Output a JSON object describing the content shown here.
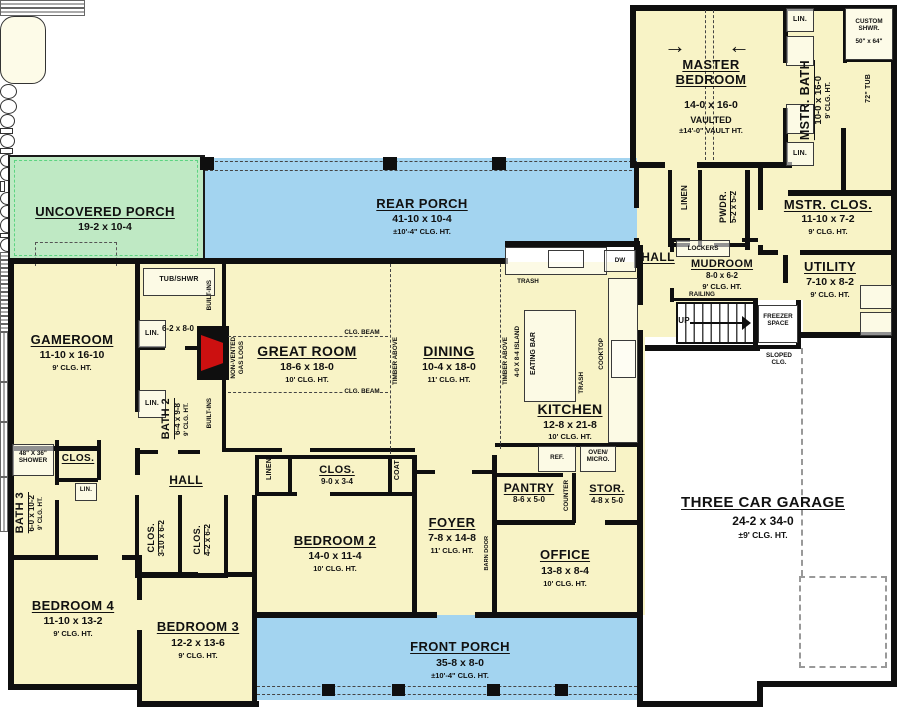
{
  "colors": {
    "room_fill": "#f8f3c6",
    "porch_blue": "#a3d4f0",
    "porch_green": "#bfe9c4",
    "wall": "#0f0f0f",
    "fireplace_red": "#cc1010",
    "garage_fill": "#ffffff"
  },
  "rooms": {
    "master_bedroom": {
      "name": "MASTER BEDROOM",
      "dim": "14-0 x 16-0",
      "note": "VAULTED",
      "clg": "±14'-0\" VAULT HT."
    },
    "mstr_bath": {
      "name": "MSTR. BATH",
      "dim": "10-0 x 16-0",
      "clg": "9' CLG. HT."
    },
    "mstr_clos": {
      "name": "MSTR. CLOS.",
      "dim": "11-10 x 7-2",
      "clg": "9' CLG. HT."
    },
    "utility": {
      "name": "UTILITY",
      "dim": "7-10 x 8-2",
      "clg": "9' CLG. HT."
    },
    "mudroom": {
      "name": "MUDROOM",
      "dim": "8-0 x 6-2",
      "clg": "9' CLG. HT."
    },
    "pwdr": {
      "name": "PWDR.",
      "dim": "5-2 x 5-2"
    },
    "rear_porch": {
      "name": "REAR PORCH",
      "dim": "41-10 x 10-4",
      "clg": "±10'-4\" CLG. HT."
    },
    "uncovered_porch": {
      "name": "UNCOVERED PORCH",
      "dim": "19-2 x 10-4"
    },
    "front_porch": {
      "name": "FRONT PORCH",
      "dim": "35-8 x 8-0",
      "clg": "±10'-4\" CLG. HT."
    },
    "gameroom": {
      "name": "GAMEROOM",
      "dim": "11-10 x 16-10",
      "clg": "9' CLG. HT."
    },
    "bath2": {
      "name": "BATH 2",
      "dim": "6-4 x 9-8",
      "clg": "9' CLG. HT.",
      "tub_room_dim": "6-2 x 8-0"
    },
    "great_room": {
      "name": "GREAT ROOM",
      "dim": "18-6 x 18-0",
      "clg": "10' CLG. HT."
    },
    "dining": {
      "name": "DINING",
      "dim": "10-4 x 18-0",
      "clg": "11' CLG. HT."
    },
    "kitchen": {
      "name": "KITCHEN",
      "dim": "12-8 x 21-8",
      "clg": "10' CLG. HT."
    },
    "pantry": {
      "name": "PANTRY",
      "dim": "8-6 x 5-0"
    },
    "stor": {
      "name": "STOR.",
      "dim": "4-8 x 5-0"
    },
    "foyer": {
      "name": "FOYER",
      "dim": "7-8 x 14-8",
      "clg": "11' CLG. HT."
    },
    "office": {
      "name": "OFFICE",
      "dim": "13-8 x 8-4",
      "clg": "10' CLG. HT."
    },
    "bedroom2": {
      "name": "BEDROOM 2",
      "dim": "14-0 x 11-4",
      "clg": "10' CLG. HT."
    },
    "bedroom3": {
      "name": "BEDROOM 3",
      "dim": "12-2 x 13-6",
      "clg": "9' CLG. HT."
    },
    "bedroom4": {
      "name": "BEDROOM 4",
      "dim": "11-10 x 13-2",
      "clg": "9' CLG. HT."
    },
    "bath3": {
      "name": "BATH 3",
      "dim": "6-0 x 10-2",
      "clg": "9' CLG. HT."
    },
    "clos_bedroom2": {
      "name": "CLOS.",
      "dim": "9-0 x 3-4"
    },
    "clos_hall_a": {
      "name": "CLOS.",
      "dim": "3-10 x 6-2"
    },
    "clos_hall_b": {
      "name": "CLOS.",
      "dim": "4-2 x 6-2"
    },
    "clos_bath3": {
      "name": "CLOS."
    },
    "garage": {
      "name": "THREE CAR GARAGE",
      "dim": "24-2 x 34-0",
      "clg": "±9' CLG. HT."
    }
  },
  "labels": {
    "hall": "HALL",
    "linen": "LINEN",
    "lin": "LIN.",
    "lockers": "LOCKERS",
    "railing": "RAILING",
    "up": "UP",
    "freezer_space": "FREEZER SPACE",
    "sloped_clg": "SLOPED CLG.",
    "custom_shwr": "CUSTOM SHWR.",
    "custom_shwr_size": "50\" x 64\"",
    "tub72": "72\" TUB",
    "tub_shwr": "TUB/SHWR",
    "shower48": "48\" X 36\" SHOWER",
    "built_ins": "BUILT-INS",
    "non_vented_1": "NON-VENTED",
    "non_vented_2": "GAS LOGS",
    "clg_beam": "CLG. BEAM",
    "timber_above": "TIMBER ABOVE",
    "island": "4-0 X 8-4 ISLAND",
    "eating_bar": "EATING BAR",
    "trash": "TRASH",
    "dw": "DW",
    "cooktop": "COOKTOP",
    "ref": "REF.",
    "oven_micro": "OVEN/ MICRO.",
    "counter": "COUNTER",
    "barn_door": "BARN DOOR",
    "coat": "COAT"
  }
}
